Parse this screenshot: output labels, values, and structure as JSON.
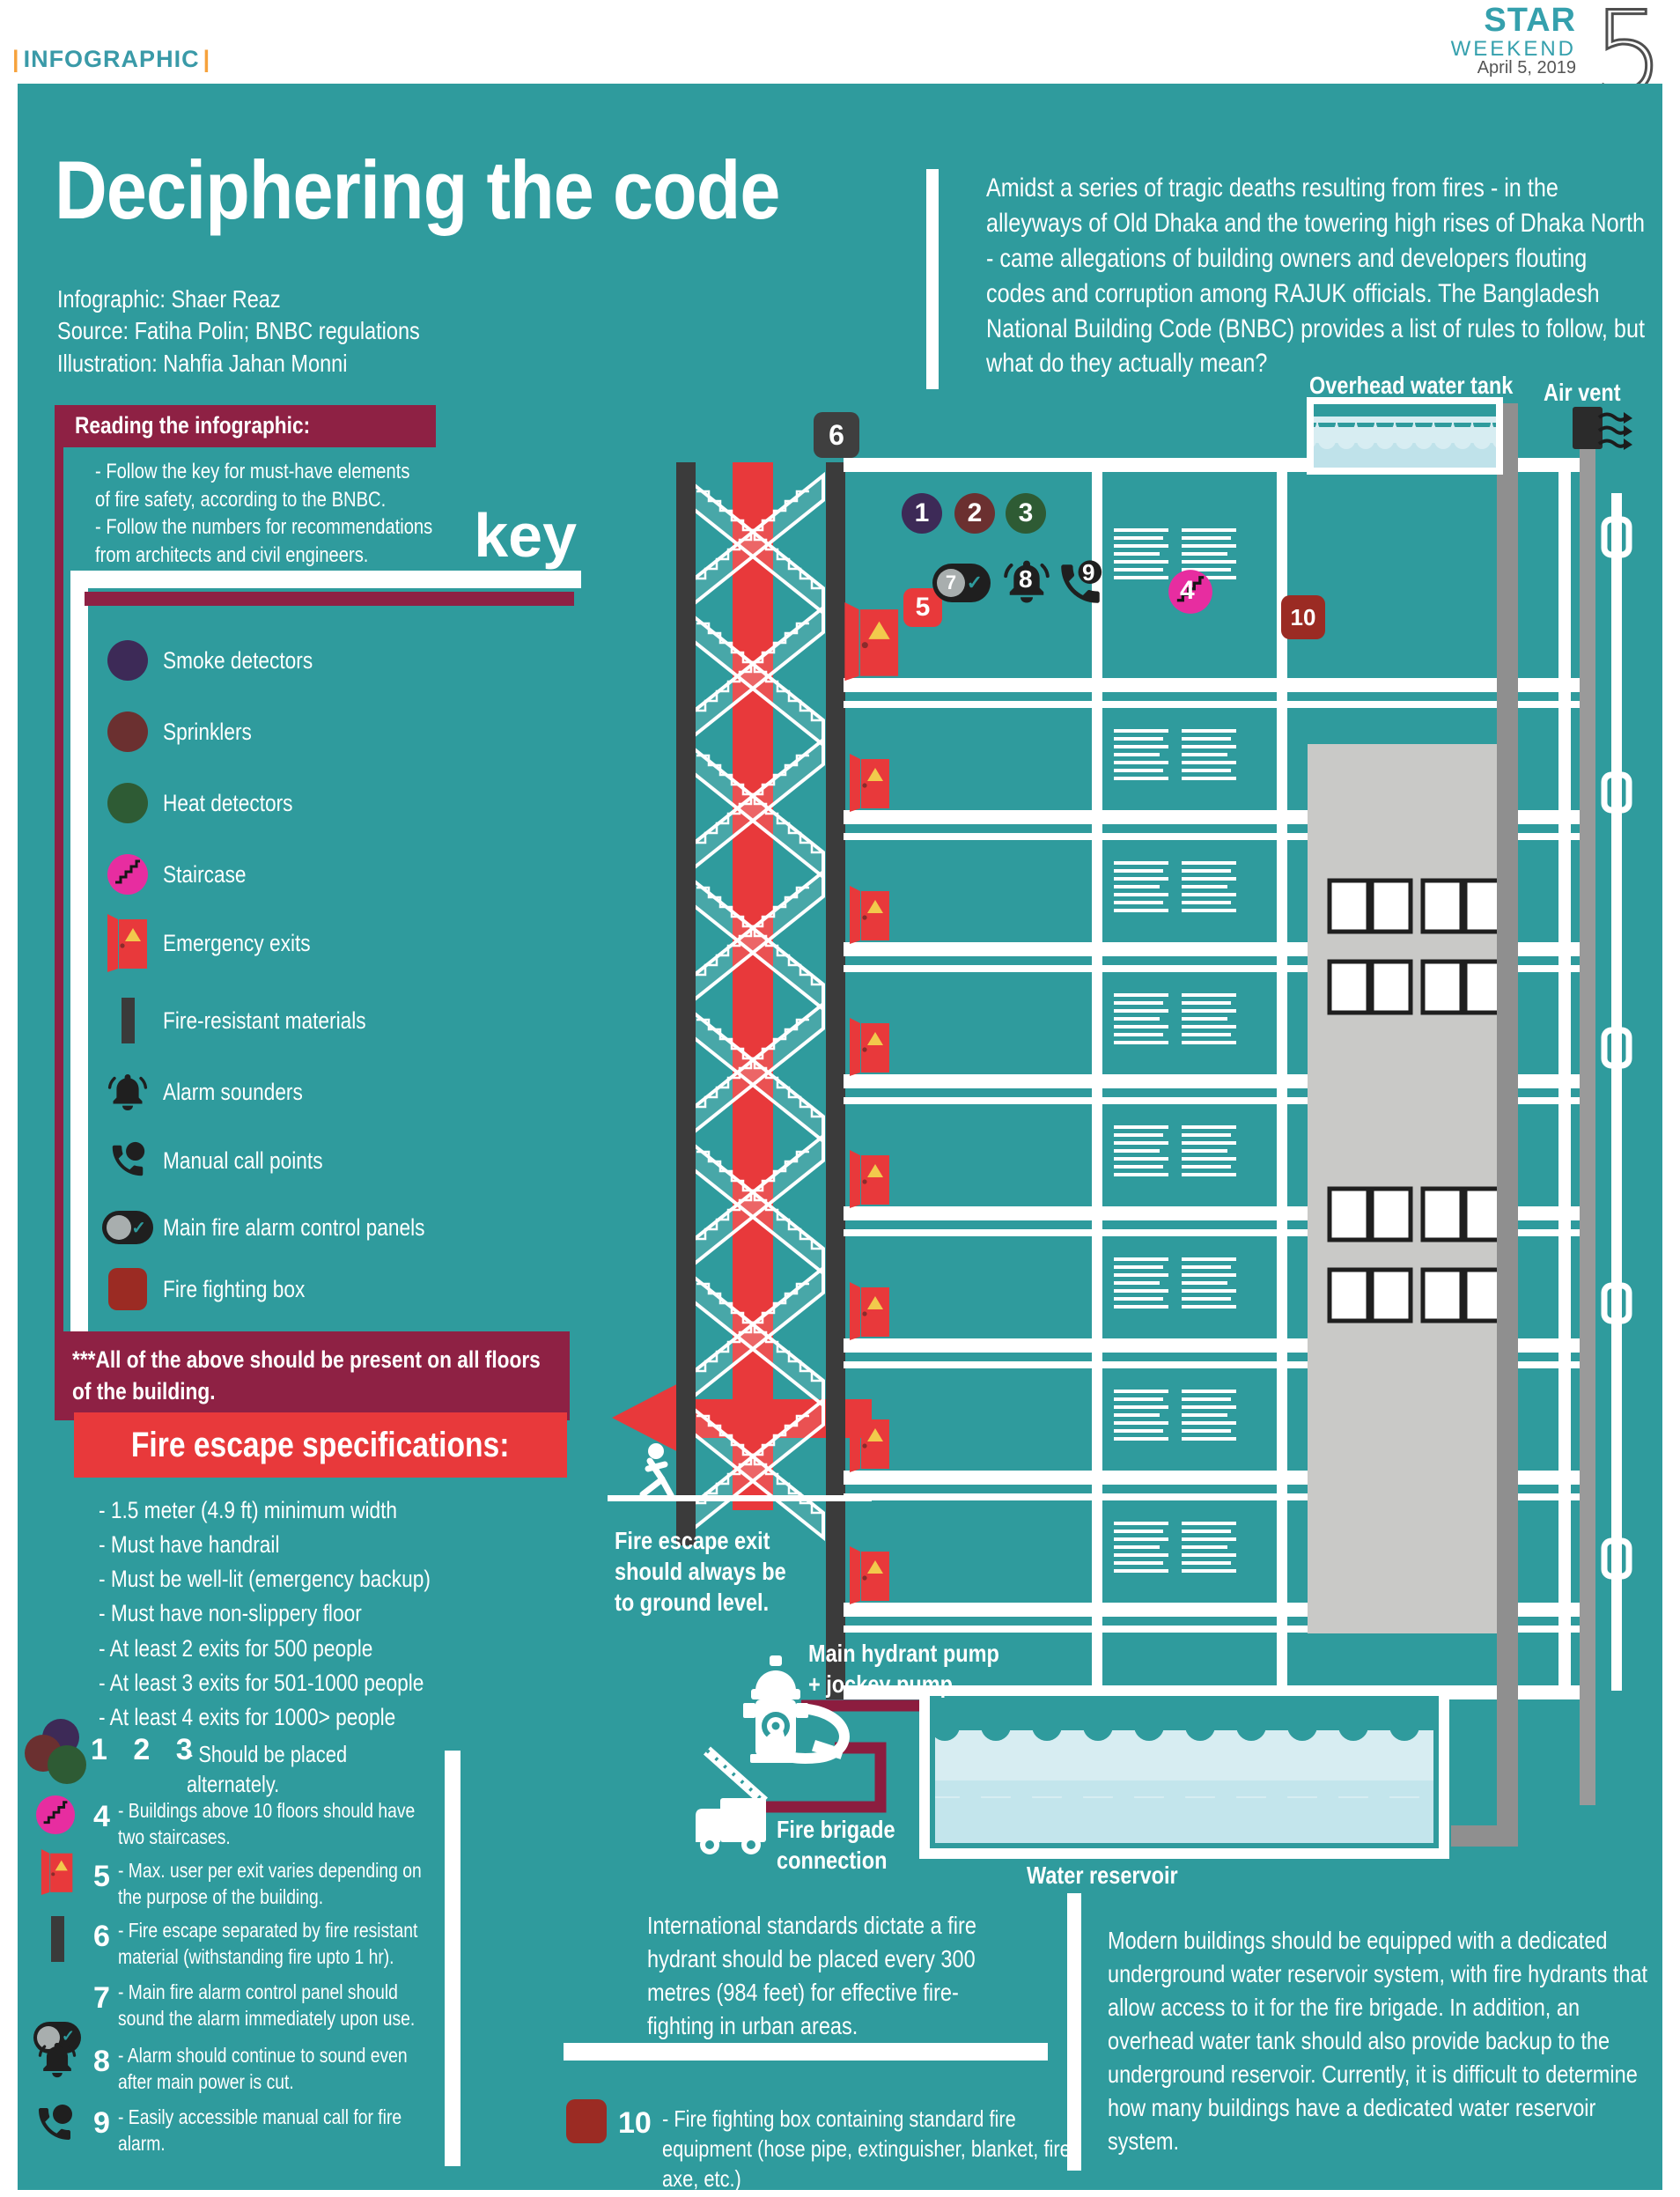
{
  "masthead": {
    "section_label": "INFOGRAPHIC",
    "brand_top": "STAR",
    "brand_bottom": "WEEKEND",
    "date": "April 5, 2019",
    "page_number": "5"
  },
  "header": {
    "title": "Deciphering the code",
    "credits": [
      "Infographic: Shaer Reaz",
      "Source: Fatiha Polin; BNBC regulations",
      "Illustration: Nahfia Jahan Monni"
    ],
    "intro": "Amidst a series of tragic deaths resulting from fires - in the alleyways of Old Dhaka and the towering high rises of Dhaka North - came allegations of building owners and developers flouting codes and corruption among RAJUK officials. The Bangladesh National Building Code (BNBC) provides a list of rules to follow, but what do they actually mean?"
  },
  "reading_box": {
    "title": "Reading the infographic:",
    "body": "- Follow the key for must-have elements\nof fire safety, according to the BNBC.\n- Follow the numbers for recommendations\nfrom architects and civil engineers."
  },
  "key": {
    "heading": "key",
    "items": [
      {
        "label": "Smoke detectors",
        "icon": "smoke-detector-circle"
      },
      {
        "label": "Sprinklers",
        "icon": "sprinkler-circle"
      },
      {
        "label": "Heat detectors",
        "icon": "heat-detector-circle"
      },
      {
        "label": "Staircase",
        "icon": "staircase-circle"
      },
      {
        "label": "Emergency exits",
        "icon": "emergency-exit-door"
      },
      {
        "label": "Fire-resistant materials",
        "icon": "fire-resistant-bar"
      },
      {
        "label": "Alarm sounders",
        "icon": "alarm-bell"
      },
      {
        "label": "Manual call points",
        "icon": "call-point-phone"
      },
      {
        "label": "Main fire alarm control panels",
        "icon": "control-panel-toggle"
      },
      {
        "label": "Fire fighting box",
        "icon": "fire-fighting-box"
      }
    ],
    "footnote": "***All of the above should be present on all floors of the building."
  },
  "fire_escape_specs": {
    "title": "Fire escape specifications:",
    "items": [
      "- 1.5 meter (4.9 ft) minimum width",
      "- Must have handrail",
      "- Must be well-lit (emergency backup)",
      "- Must have non-slippery floor",
      "- At least 2 exits for 500 people",
      "- At least 3 exits for 501-1000 people",
      "- At least 4 exits for 1000> people"
    ]
  },
  "illustration": {
    "overhead_tank_label": "Overhead water tank",
    "air_vent_label": "Air vent",
    "fire_escape_exit_note": "Fire escape exit\nshould always be\nto ground level.",
    "hydrant_label": "Main hydrant pump\n+ jockey pump",
    "fire_brigade_label": "Fire brigade\nconnection",
    "water_reservoir_label": "Water reservoir",
    "markers": {
      "m1": "1",
      "m2": "2",
      "m3": "3",
      "m4": "4",
      "m5": "5",
      "m6": "6",
      "m7": "7",
      "m8": "8",
      "m9": "9",
      "m10": "10"
    }
  },
  "notes": {
    "n123": {
      "badges": "1  2  3",
      "text": "- Should be placed alternately."
    },
    "n4": {
      "badge": "4",
      "text": "- Buildings above 10 floors should have two staircases."
    },
    "n5": {
      "badge": "5",
      "text": "- Max. user per exit varies depending on the purpose of the building."
    },
    "n6": {
      "badge": "6",
      "text": "- Fire escape separated by fire resistant material (withstanding fire upto 1 hr)."
    },
    "n7": {
      "badge": "7",
      "text": "- Main fire alarm control panel should sound the alarm immediately upon use."
    },
    "n8": {
      "badge": "8",
      "text": "- Alarm should continue to sound even after main power is cut."
    },
    "n9": {
      "badge": "9",
      "text": "- Easily accessible manual call for fire alarm."
    },
    "n10": {
      "badge": "10",
      "text": "- Fire fighting box containing standard fire equipment (hose pipe, extinguisher, blanket, fire axe, etc.)"
    }
  },
  "paragraphs": {
    "hydrant_standard": "International standards dictate a fire hydrant should be placed every 300 metres (984 feet) for effective fire-fighting in urban areas.",
    "reservoir": "Modern buildings should be equipped with a dedicated underground water reservoir system, with fire hydrants that allow access to it for the fire brigade. In addition, an overhead water tank should also provide backup to the underground reservoir. Currently, it is difficult to determine how many buildings have a dedicated water reservoir system."
  },
  "colors": {
    "teal_bg": "#2f9b9d",
    "maroon": "#8e2144",
    "red": "#e8393b",
    "dark_red_box": "#9b2b23",
    "smoke_purple": "#3d2a57",
    "sprinkler_brown": "#6b3030",
    "heat_green": "#2e5b34",
    "staircase_pink": "#e72da0",
    "dark_icon": "#1f1f1f",
    "water_light": "#d7edf2",
    "water_mid": "#bfe2ea",
    "gray_tower": "#c9c9c7",
    "gray_pipe": "#8f8f8f",
    "logo_teal": "#35a0ad",
    "accent_orange": "#f6a23c"
  }
}
